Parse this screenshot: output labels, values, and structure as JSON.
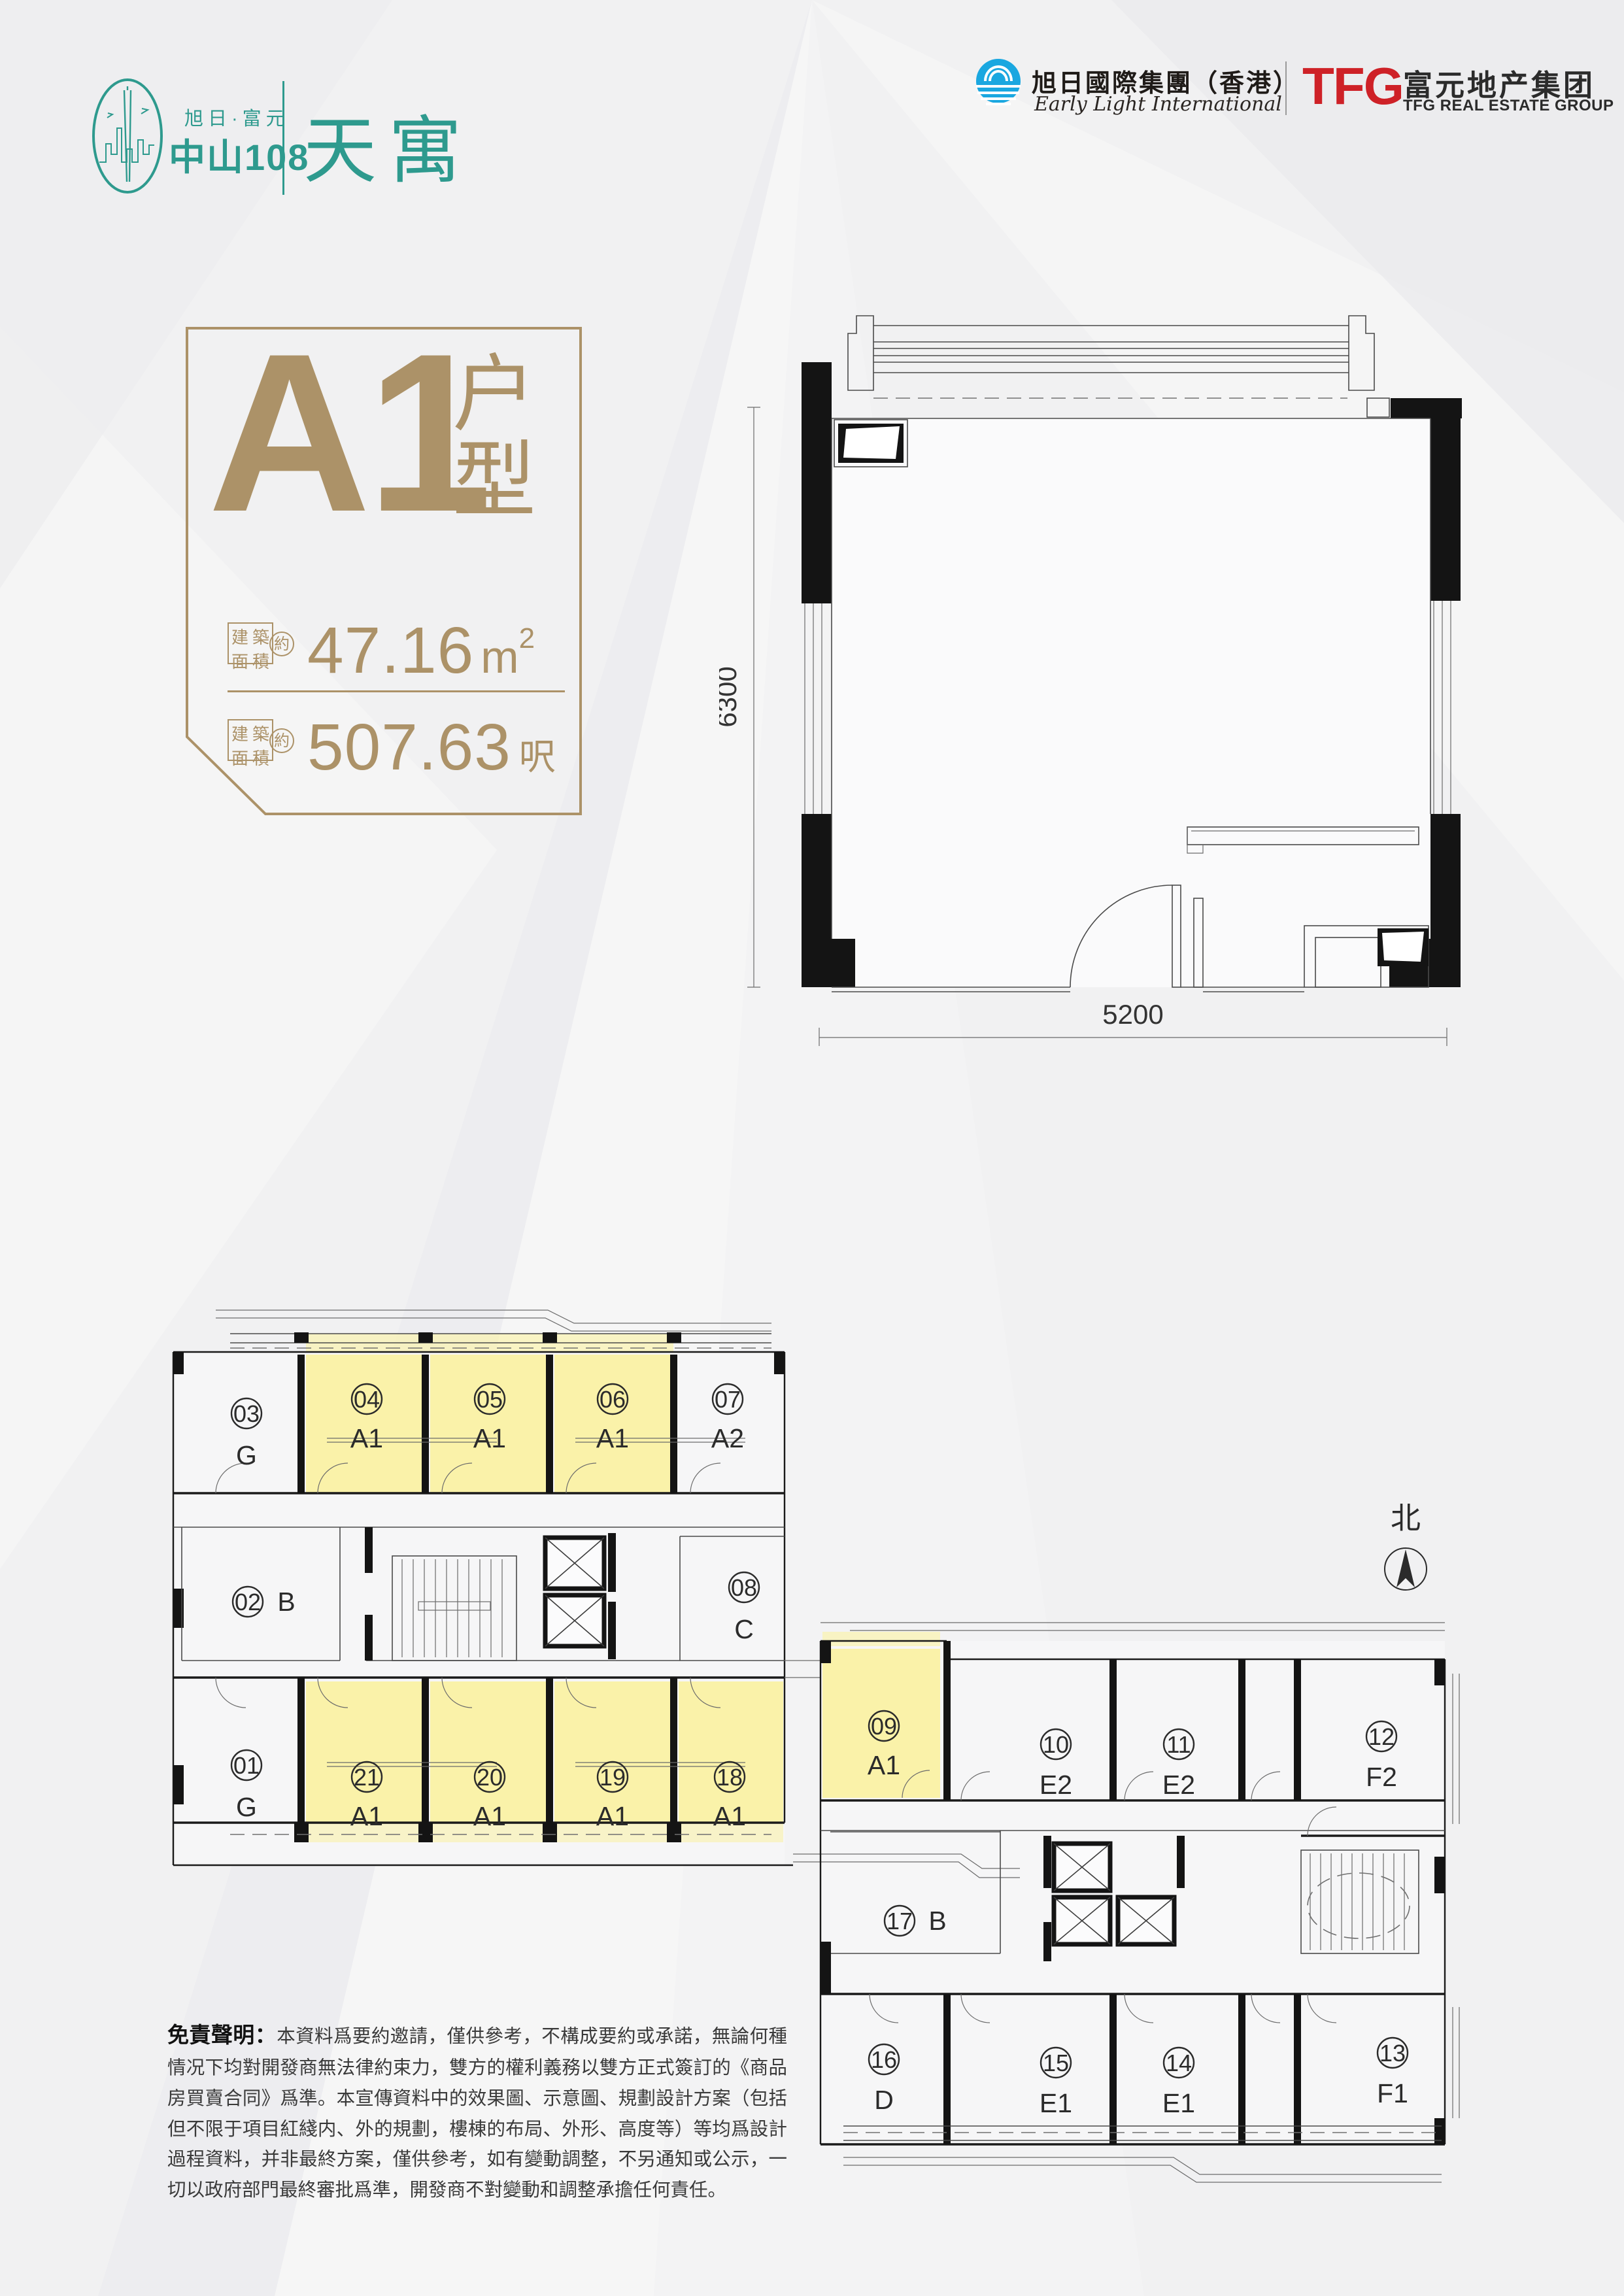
{
  "brand": {
    "tagline": "旭日·富元",
    "name": "中山108",
    "product": "天寓"
  },
  "developers": {
    "early_light_cn": "旭日國際集團（香港）",
    "early_light_en": "Early Light International",
    "tfg_abbr": "TFG",
    "tfg_cn": "富元地产集团",
    "tfg_en": "TFG REAL ESTATE GROUP"
  },
  "unit_card": {
    "unit_code": "A1",
    "suffix_top": "户",
    "suffix_bottom": "型",
    "label_chars": [
      "建",
      "築",
      "面",
      "積"
    ],
    "approx": "約",
    "sqm_value": "47.16",
    "sqm_unit": "m",
    "sqm_sup": "2",
    "sqft_value": "507.63",
    "sqft_unit": "呎"
  },
  "plan": {
    "dim_height": "6300",
    "dim_width": "5200"
  },
  "floorplate": {
    "north_label": "北",
    "units": [
      {
        "number": "03",
        "type": "G",
        "highlighted": false
      },
      {
        "number": "04",
        "type": "A1",
        "highlighted": true
      },
      {
        "number": "05",
        "type": "A1",
        "highlighted": true
      },
      {
        "number": "06",
        "type": "A1",
        "highlighted": true
      },
      {
        "number": "07",
        "type": "A2",
        "highlighted": false
      },
      {
        "number": "02",
        "type": "B",
        "highlighted": false
      },
      {
        "number": "08",
        "type": "C",
        "highlighted": false
      },
      {
        "number": "01",
        "type": "G",
        "highlighted": false
      },
      {
        "number": "21",
        "type": "A1",
        "highlighted": true
      },
      {
        "number": "20",
        "type": "A1",
        "highlighted": true
      },
      {
        "number": "19",
        "type": "A1",
        "highlighted": true
      },
      {
        "number": "18",
        "type": "A1",
        "highlighted": true
      },
      {
        "number": "09",
        "type": "A1",
        "highlighted": true
      },
      {
        "number": "10",
        "type": "E2",
        "highlighted": false
      },
      {
        "number": "11",
        "type": "E2",
        "highlighted": false
      },
      {
        "number": "12",
        "type": "F2",
        "highlighted": false
      },
      {
        "number": "17",
        "type": "B",
        "highlighted": false
      },
      {
        "number": "16",
        "type": "D",
        "highlighted": false
      },
      {
        "number": "15",
        "type": "E1",
        "highlighted": false
      },
      {
        "number": "14",
        "type": "E1",
        "highlighted": false
      },
      {
        "number": "13",
        "type": "F1",
        "highlighted": false
      }
    ]
  },
  "disclaimer": {
    "title": "免責聲明：",
    "body": "本資料爲要約邀請，僅供參考，不構成要約或承諾，無論何種情况下均對開發商無法律約束力，雙方的權利義務以雙方正式簽訂的《商品房買賣合同》爲準。本宣傳資料中的效果圖、示意圖、規劃設計方案（包括但不限于項目紅綫内、外的規劃，樓棟的布局、外形、高度等）等均爲設計過程資料，并非最終方案，僅供參考，如有變動調整，不另通知或公示，一切以政府部門最終審批爲準，開發商不對變動和調整承擔任何責任。"
  },
  "colors": {
    "accent_teal": "#2E9A8E",
    "accent_gold": "#AC9268",
    "highlight_yellow": "#FAF2A9",
    "logo_red": "#CE2127",
    "logo_blue": "#1AA7E0",
    "wall_black": "#141414",
    "background": "#f1f1f2"
  }
}
